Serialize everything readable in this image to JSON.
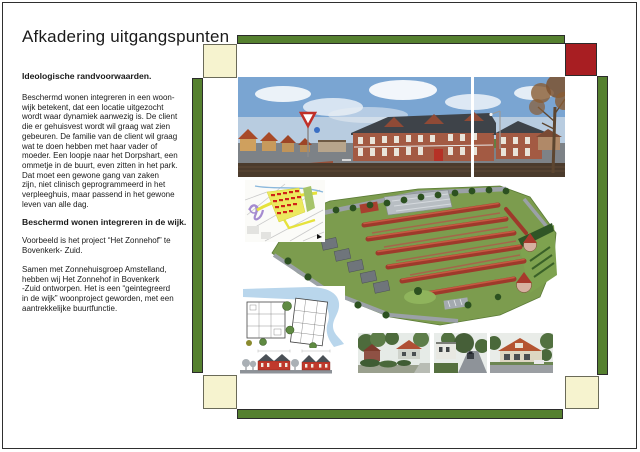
{
  "header": {
    "title": "Afkadering uitgangspunten"
  },
  "text_column": {
    "heading_ideological": "Ideologische randvoorwaarden.",
    "paragraph_integration": "Beschermd wonen integreren in een woon-\nwijk betekent, dat een locatie uitgezocht\nwordt waar dynamiek aanwezig is. De client\ndie er gehuisvest wordt wil graag wat zien\ngebeuren. De familie van de client wil graag\nwat te doen hebben met haar vader of\nmoeder. Een loopje naar het Dorpshart, een\nommetje in de buurt, even zitten in het park.\nDat moet een gewone gang van zaken\nzijn, niet clinisch geprogrammeerd in het\nverpleeghuis, maar passend in het gewone\nleven van alle dag.",
    "heading_district": "Beschermd wonen integreren in de wijk.",
    "paragraph_example": "Voorbeeld is het project “Het Zonnehof” te\nBovenkerk- Zuid.",
    "paragraph_zonnehuisgroep": "Samen met Zonnehuisgroep Amstelland,\nhebben wij Het Zonnehof in Bovenkerk\n-Zuid ontworpen. Het is een “geintegreerd\nin de wijk” woonproject geworden, met een\naantrekkelijke buurtfunctie."
  },
  "figures": {
    "panorama": "Straatpanorama met nieuwe woongebouwen Het Zonnehof",
    "city_map": "Plattegrond Bovenkerk-Zuid met projectlocatie",
    "aerial_plan": "Vogelvlucht maquette van de woonwijk",
    "floor_plan": "Plattegrondtekening woongebouw met waterpartij",
    "elevation": "Geveltekening met rode woningen",
    "photo_1": "Buurtfoto woning met rood dak en tuin",
    "photo_2": "Buurtfoto witte woning aan straat",
    "photo_3": "Buurtfoto vrijstaand huis met oranje dak"
  },
  "colors": {
    "frame_green": "#55802f",
    "corner_yellow": "#f6f3cf",
    "corner_red": "#a81e22",
    "page_border": "#2f2f2f",
    "text_color": "#1a1a1a"
  }
}
